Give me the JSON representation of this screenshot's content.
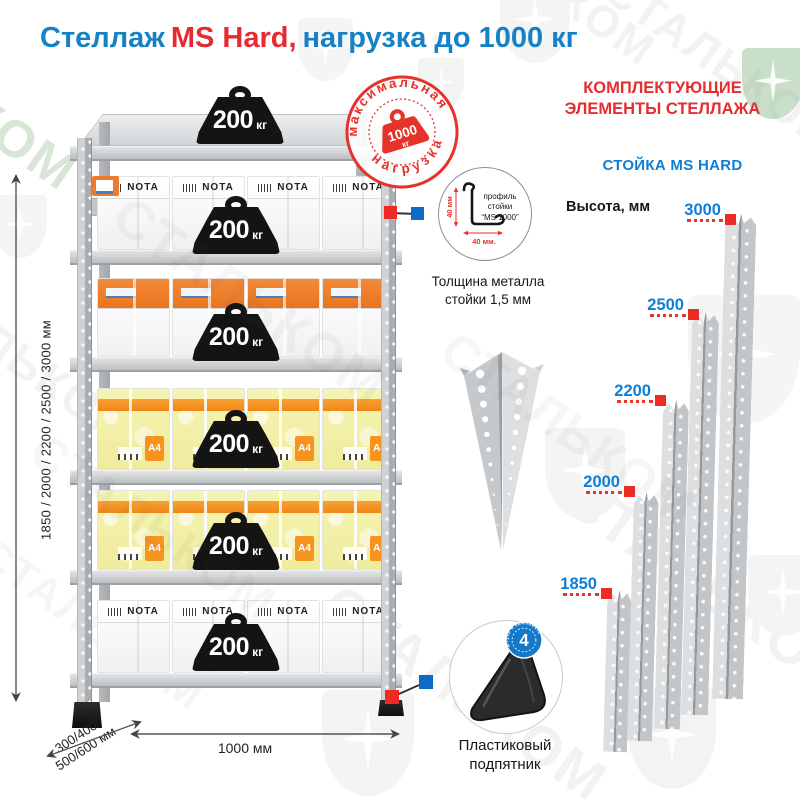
{
  "watermark": {
    "brand": "СТАЛЬКОМ"
  },
  "title": {
    "part1": "Стеллаж",
    "part2": "MS Hard,",
    "part3": "нагрузка до 1000 кг"
  },
  "rack": {
    "load_badge": {
      "value": "200",
      "unit": "кг"
    },
    "max_load_stamp": {
      "arc_top": "максимальная",
      "arc_bottom": "нагрузка",
      "value": "1000",
      "unit": "кг"
    },
    "dims": {
      "height_options": "1850 / 2000 / 2200 / 2500 / 3000 мм",
      "depth_line1": "300/400/",
      "depth_line2": "500/600 мм",
      "width": "1000 мм"
    },
    "boxes": {
      "brand": "NOTA",
      "paper": "A4"
    }
  },
  "components": {
    "heading1": "КОМПЛЕКТУЮЩИЕ",
    "heading2": "ЭЛЕМЕНТЫ СТЕЛЛАЖА",
    "post_title": "СТОЙКА MS HARD",
    "height_label": "Высота, мм",
    "post_heights": [
      "1850",
      "2000",
      "2200",
      "2500",
      "3000"
    ],
    "profile": {
      "caption1": "профиль",
      "caption2": "стойки",
      "caption3": "“MS 1000”",
      "dim_vertical": "40 мм",
      "dim_horizontal": "40 мм.",
      "thickness1": "Толщина металла",
      "thickness2": "стойки 1,5 мм"
    },
    "foot": {
      "badge_value": "4",
      "badge_text": "штуки в комплекте",
      "caption1": "Пластиковый",
      "caption2": "подпятник"
    }
  }
}
